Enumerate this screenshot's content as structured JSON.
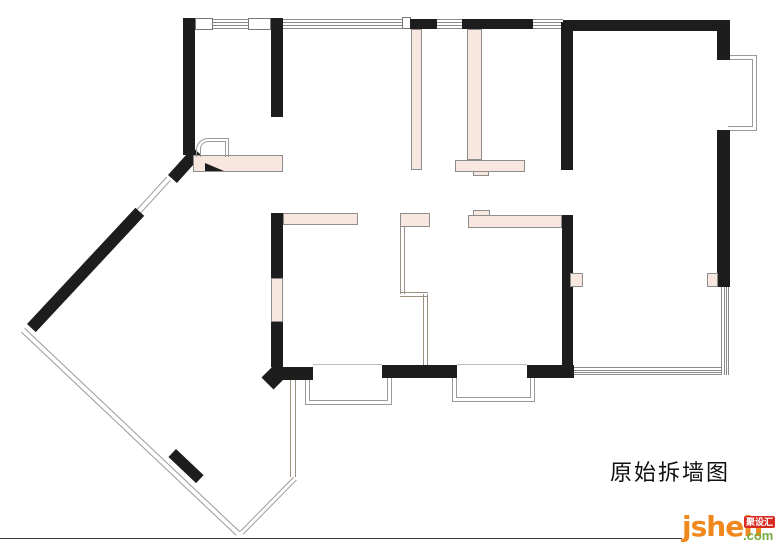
{
  "title": {
    "text": "原始拆墙图"
  },
  "watermark": {
    "brand": "jsheh",
    "badge": "聚设汇",
    "tld": ".com"
  },
  "colors": {
    "wall": "#1d1d1d",
    "demolish_highlight": "#f8e7df",
    "outline_gray": "#8d8d8d",
    "window_gray": "#9a9a9a",
    "brand_orange": "#f0881e",
    "brand_green": "#74ae3e",
    "badge_red": "#d92c21",
    "footer_rule": "#3c3c3c"
  },
  "plan": {
    "walls": [
      {
        "name": "wall-left-upper",
        "x": 183,
        "y": 18,
        "w": 12,
        "h": 137
      },
      {
        "name": "wall-top-mid-vertical",
        "x": 271,
        "y": 18,
        "w": 12,
        "h": 99
      },
      {
        "name": "wall-top-seg-a",
        "x": 410,
        "y": 19,
        "w": 27,
        "h": 10
      },
      {
        "name": "wall-top-seg-b",
        "x": 462,
        "y": 19,
        "w": 71,
        "h": 10
      },
      {
        "name": "wall-top-right",
        "x": 563,
        "y": 20,
        "w": 167,
        "h": 11
      },
      {
        "name": "wall-right-upper",
        "x": 717,
        "y": 31,
        "w": 13,
        "h": 29
      },
      {
        "name": "wall-right-mid",
        "x": 717,
        "y": 130,
        "w": 13,
        "h": 157
      },
      {
        "name": "wall-right-room-left-upper",
        "x": 561,
        "y": 22,
        "w": 12,
        "h": 148
      },
      {
        "name": "wall-right-room-left-lower",
        "x": 562,
        "y": 215,
        "w": 11,
        "h": 163
      },
      {
        "name": "wall-bottom-right",
        "x": 527,
        "y": 365,
        "w": 47,
        "h": 13
      },
      {
        "name": "wall-bottom-mid",
        "x": 382,
        "y": 365,
        "w": 75,
        "h": 13
      },
      {
        "name": "wall-bottom-left",
        "x": 272,
        "y": 367,
        "w": 41,
        "h": 13
      },
      {
        "name": "wall-center-left-upper",
        "x": 271,
        "y": 213,
        "w": 12,
        "h": 65
      },
      {
        "name": "wall-center-left-lower",
        "x": 271,
        "y": 322,
        "w": 12,
        "h": 45
      }
    ],
    "diagonal_walls": [
      {
        "name": "wall-diagonal-upper",
        "x": 168,
        "y": 175,
        "len": 37,
        "thick": 12,
        "angle": -48
      },
      {
        "name": "wall-diagonal-main",
        "x": 27,
        "y": 324,
        "len": 159,
        "thick": 12,
        "angle": -47
      },
      {
        "name": "wall-balcony-stub",
        "x": 176,
        "y": 449,
        "len": 38,
        "thick": 11,
        "angle": 43.4
      }
    ],
    "diamond": {
      "name": "wall-end-diamond",
      "x": 273,
      "y": 377,
      "size": 17
    },
    "pink_segments": [
      {
        "name": "demolish-entry-band",
        "x": 193,
        "y": 155,
        "w": 90,
        "h": 17
      },
      {
        "name": "demolish-top-left-pier",
        "x": 411,
        "y": 29,
        "w": 11,
        "h": 141
      },
      {
        "name": "demolish-top-right-pier",
        "x": 467,
        "y": 29,
        "w": 15,
        "h": 131
      },
      {
        "name": "demolish-t-head",
        "x": 455,
        "y": 160,
        "w": 70,
        "h": 12
      },
      {
        "name": "demolish-t-notch",
        "x": 473,
        "y": 171,
        "w": 16,
        "h": 5
      },
      {
        "name": "demolish-mid-left-bar",
        "x": 283,
        "y": 213,
        "w": 75,
        "h": 12
      },
      {
        "name": "demolish-mid-center-bar",
        "x": 400,
        "y": 213,
        "w": 30,
        "h": 14
      },
      {
        "name": "demolish-mid-right-bar",
        "x": 468,
        "y": 215,
        "w": 94,
        "h": 13
      },
      {
        "name": "demolish-mid-right-notch",
        "x": 473,
        "y": 210,
        "w": 17,
        "h": 6
      },
      {
        "name": "demolish-left-wall-segment",
        "x": 271,
        "y": 278,
        "w": 12,
        "h": 44
      },
      {
        "name": "demolish-door-block-left",
        "x": 570,
        "y": 273,
        "w": 13,
        "h": 14
      },
      {
        "name": "demolish-door-block-right",
        "x": 707,
        "y": 273,
        "w": 11,
        "h": 14
      }
    ],
    "jambs": [
      {
        "name": "window-jamb-1",
        "x": 195,
        "y": 18,
        "w": 18,
        "h": 12
      },
      {
        "name": "window-jamb-2",
        "x": 248,
        "y": 18,
        "w": 23,
        "h": 12
      },
      {
        "name": "window-jamb-3",
        "x": 402,
        "y": 17,
        "w": 9,
        "h": 12
      }
    ],
    "windows_h": [
      {
        "name": "window-top-1",
        "x": 213,
        "y": 19,
        "w": 35,
        "h": 10
      },
      {
        "name": "window-top-2",
        "x": 283,
        "y": 19,
        "w": 120,
        "h": 10
      },
      {
        "name": "window-top-3",
        "x": 437,
        "y": 19,
        "w": 25,
        "h": 10
      },
      {
        "name": "window-top-4",
        "x": 533,
        "y": 19,
        "w": 30,
        "h": 10
      },
      {
        "name": "window-bottom-right",
        "x": 573,
        "y": 367,
        "w": 148,
        "h": 8
      }
    ],
    "windows_v": [
      {
        "name": "window-right-side",
        "x": 721,
        "y": 287,
        "w": 8,
        "h": 88
      }
    ],
    "bays": [
      {
        "name": "bay-window-right",
        "x": 729,
        "y": 55,
        "w": 28,
        "h": 76,
        "open": "left"
      },
      {
        "name": "bay-window-bottom-left",
        "x": 305,
        "y": 378,
        "w": 87,
        "h": 27,
        "open": "top"
      },
      {
        "name": "bay-window-bottom-right",
        "x": 452,
        "y": 378,
        "w": 83,
        "h": 24,
        "open": "top"
      }
    ],
    "diag_windows": [
      {
        "name": "window-diagonal-door",
        "x": 136,
        "y": 210,
        "len": 45,
        "h": 6,
        "angle": -47.7
      },
      {
        "name": "balcony-glass-long",
        "x": 25,
        "y": 328,
        "len": 296,
        "h": 6,
        "angle": 43.4
      },
      {
        "name": "balcony-glass-short",
        "x": 240,
        "y": 531,
        "len": 76,
        "h": 5,
        "angle": -45.5
      }
    ],
    "double_lines_v": [
      {
        "name": "balcony-glass-vertical",
        "x": 290,
        "y": 378,
        "w": 6,
        "h": 99
      },
      {
        "name": "partition-line-v1",
        "x": 400,
        "y": 227,
        "w": 5,
        "h": 67
      },
      {
        "name": "partition-line-v2",
        "x": 423,
        "y": 294,
        "w": 5,
        "h": 71
      }
    ],
    "double_lines_h": [
      {
        "name": "partition-line-h",
        "x": 400,
        "y": 292,
        "w": 28,
        "h": 5
      }
    ],
    "single_lines": [
      {
        "name": "opening-edge-left",
        "x": 313,
        "y": 364,
        "w": 69,
        "h": 1,
        "color": "#bbbbbb"
      },
      {
        "name": "opening-edge-right",
        "x": 457,
        "y": 364,
        "w": 70,
        "h": 1,
        "color": "#bbbbbb"
      },
      {
        "name": "footer-rule",
        "x": 0,
        "y": 538,
        "w": 682,
        "h": 1,
        "color": "#3c3c3c"
      }
    ],
    "door_frames": [
      {
        "name": "door-frame-outer",
        "x": 196,
        "y": 138,
        "w": 33,
        "h": 19,
        "r": 12
      },
      {
        "name": "door-frame-inner",
        "x": 200,
        "y": 141,
        "w": 26,
        "h": 16,
        "r": 8
      }
    ],
    "triangle": {
      "name": "door-swing-mark",
      "x": 205,
      "y": 163,
      "w": 19,
      "h": 8
    }
  }
}
